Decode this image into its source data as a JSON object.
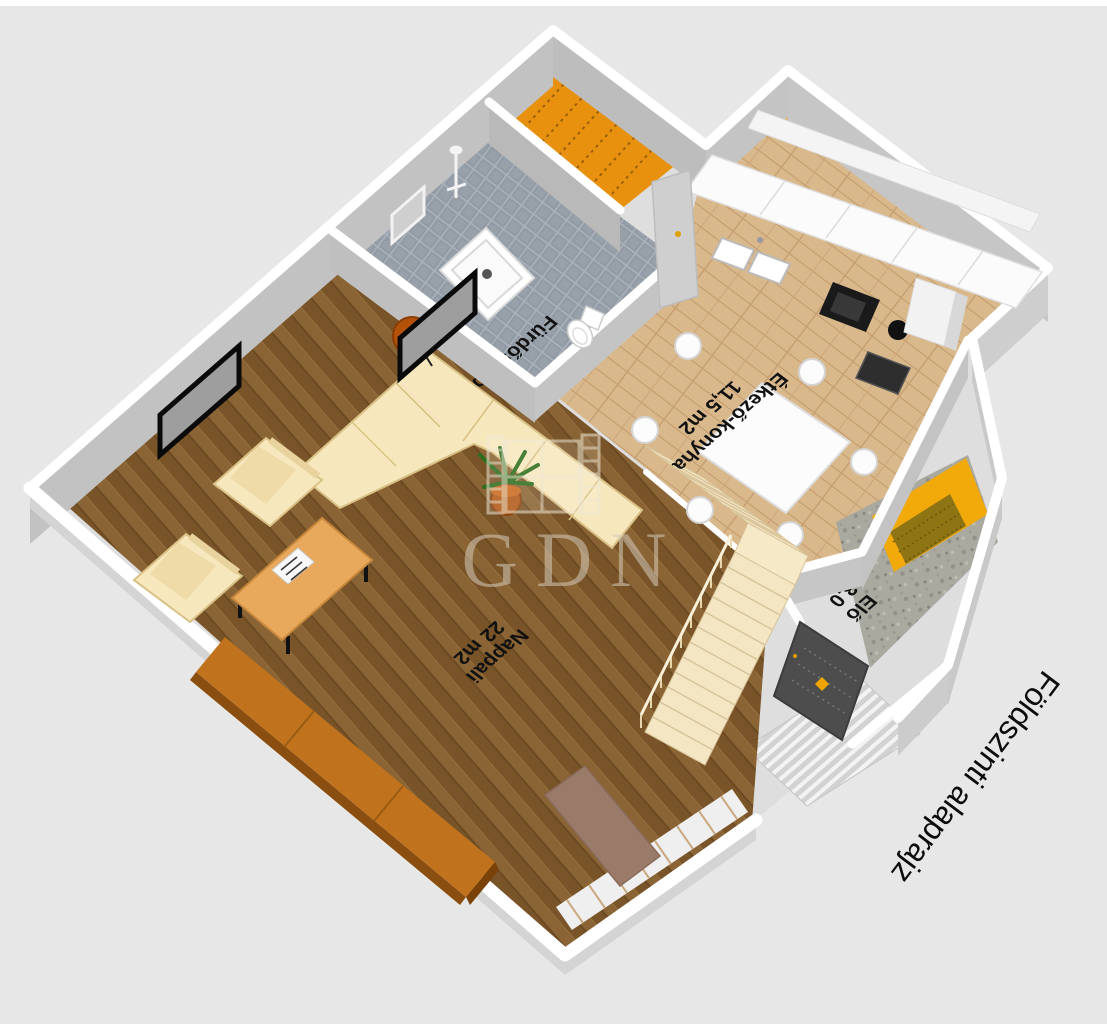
{
  "page": {
    "background": "#e7e7e7",
    "top_strip": "#ffffff"
  },
  "plan": {
    "title": "Földszinti alaprajz",
    "watermark": "GDN",
    "rooms": {
      "living": {
        "name": "Nappali",
        "area": "22 m2"
      },
      "dining_kitchen": {
        "name": "Étkező-konyha",
        "area": "11,5 m2"
      },
      "bathroom": {
        "name": "Fürdőszoba"
      },
      "hall": {
        "name": "Elő",
        "area": "3,0"
      }
    },
    "colors": {
      "wall_top": "#ffffff",
      "wall_face": "#c2c2c2",
      "living_floor": "#8a6434",
      "kitchen_floor": "#d9b88c",
      "bathroom_floor": "#98a1aa",
      "stair_room_floor": "#e8910e",
      "entry_floor": "#a9a9a0",
      "entry_mat_yellow": "#f2a90a",
      "sofa_cream": "#f6e7bd",
      "stairs_cream": "#f4e6c2",
      "sideboard_orange": "#c0731c",
      "front_door_dark": "#4d4d4d",
      "label_text": "#111111",
      "title_text": "#0c0c0c"
    }
  }
}
